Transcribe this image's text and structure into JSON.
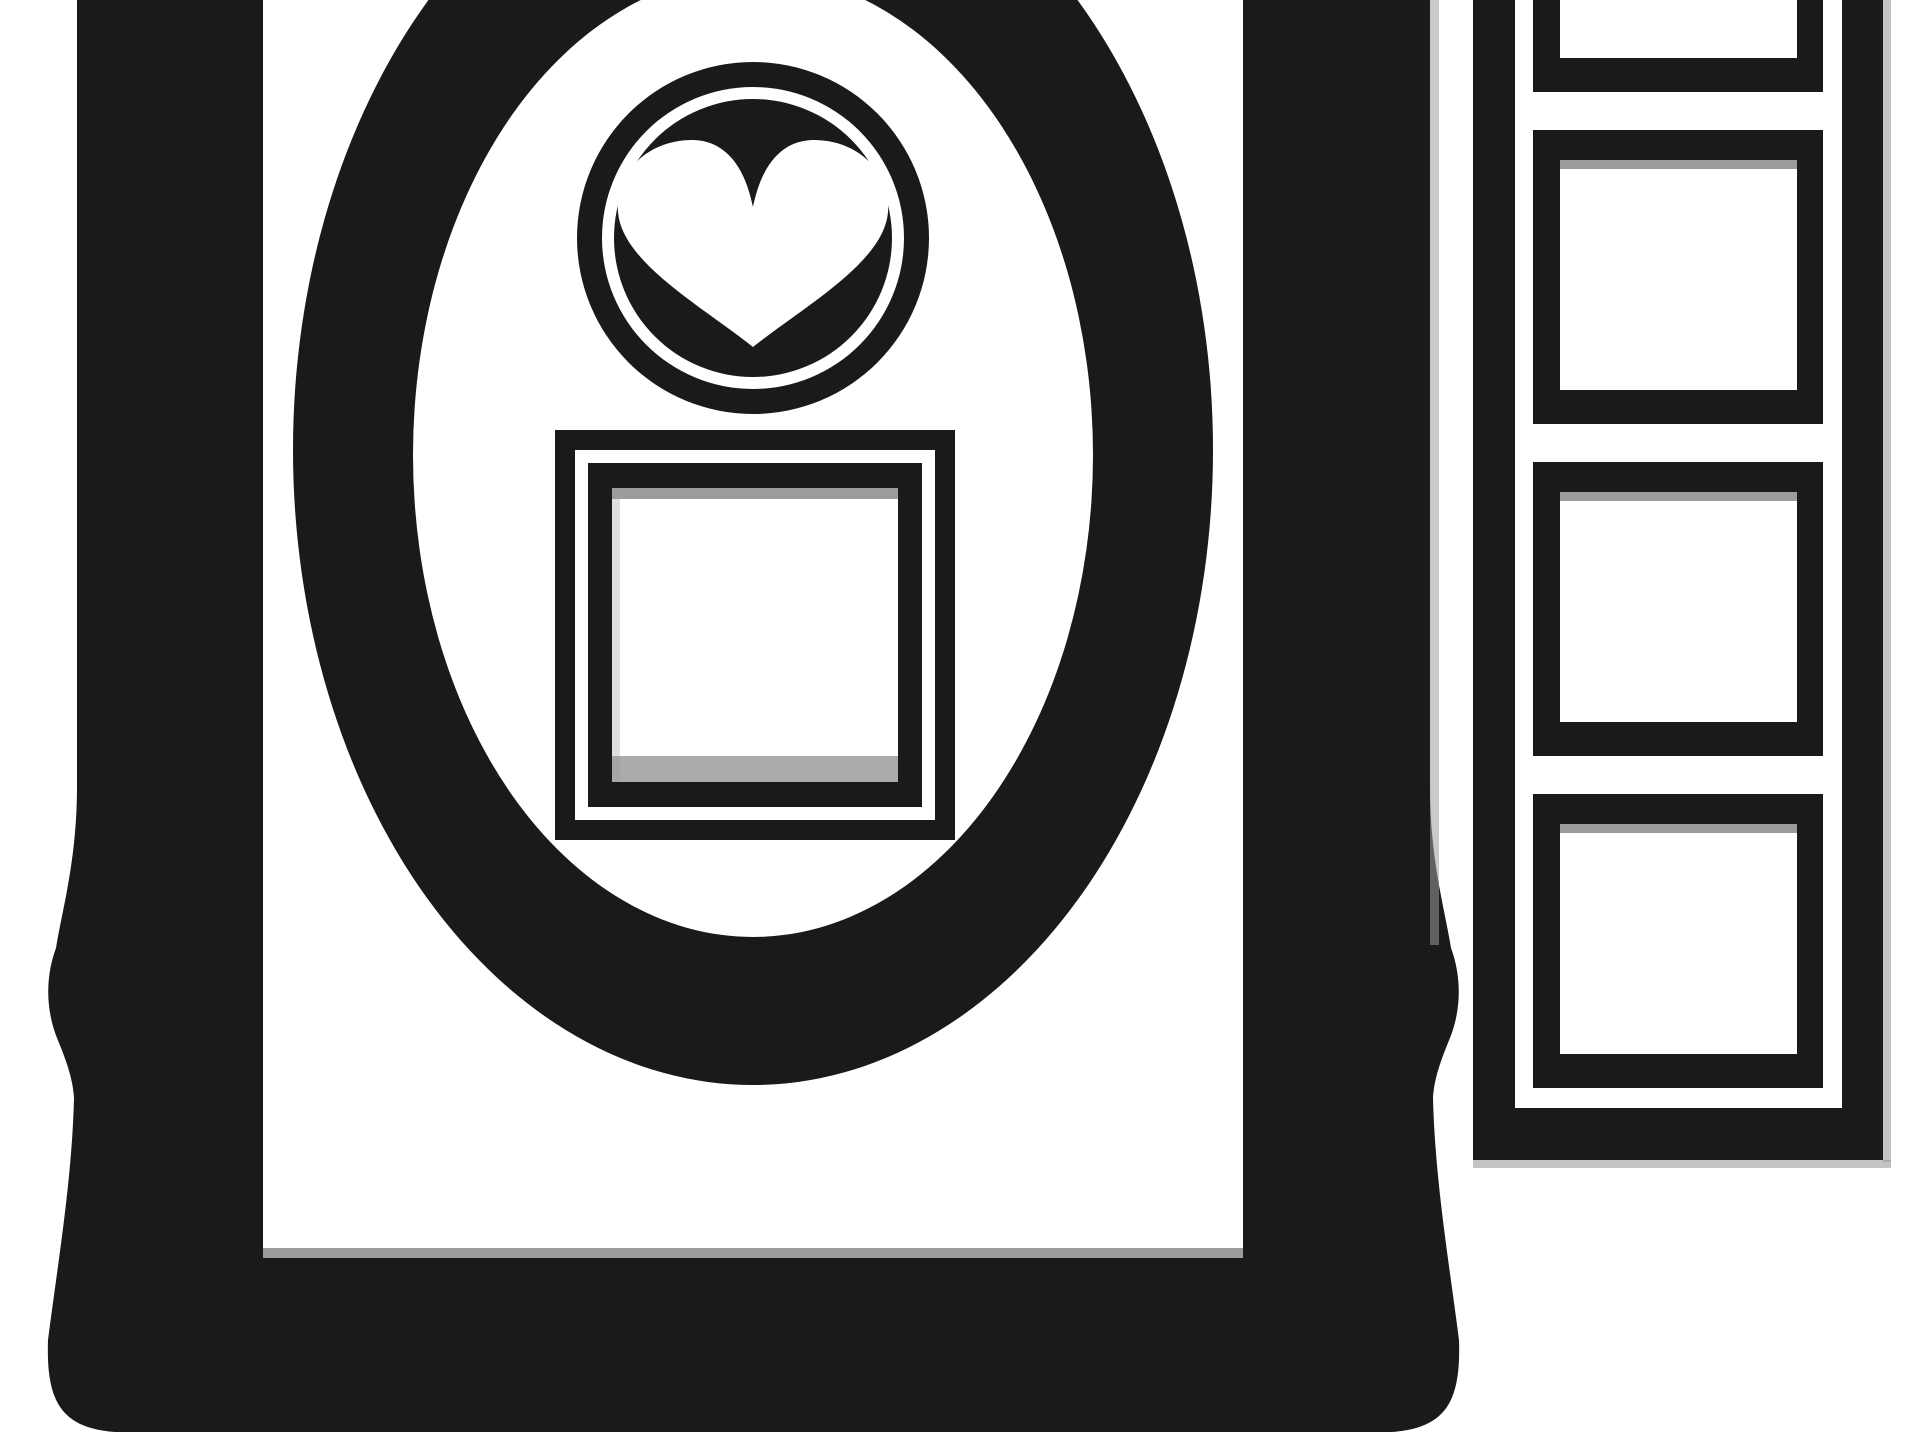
{
  "artwork": {
    "title": "Black and white picture-frames clipart",
    "style": "monochrome vector illustration, cropped at top and bottom edges",
    "colors": {
      "ink": "#1b1919",
      "paper": "#ffffff",
      "shadow": "#9c9c9c",
      "shadow_light": "#c9c9c9"
    },
    "elements": {
      "main_frame": {
        "name": "ornate-picture-frame",
        "description": "large rectangular frame, thick border, molded waist and knob on each side, flared rounded bottom corners, top edge cropped"
      },
      "oval_frame": {
        "name": "oval-frame-ring",
        "description": "thick oval ring inside the main frame, cropped at top"
      },
      "heart_medallion": {
        "name": "heart-medallion",
        "description": "black circular medallion with thin white inner ring and white heart in the center",
        "icon": "heart-icon"
      },
      "square_frame": {
        "name": "square-frame",
        "description": "nested square frame (black-white-black borders) below the medallion inside the oval"
      },
      "filmstrip": {
        "name": "filmstrip-column",
        "description": "vertical strip of square frame windows on the right, cropped at top",
        "cells_count": 4
      }
    }
  }
}
